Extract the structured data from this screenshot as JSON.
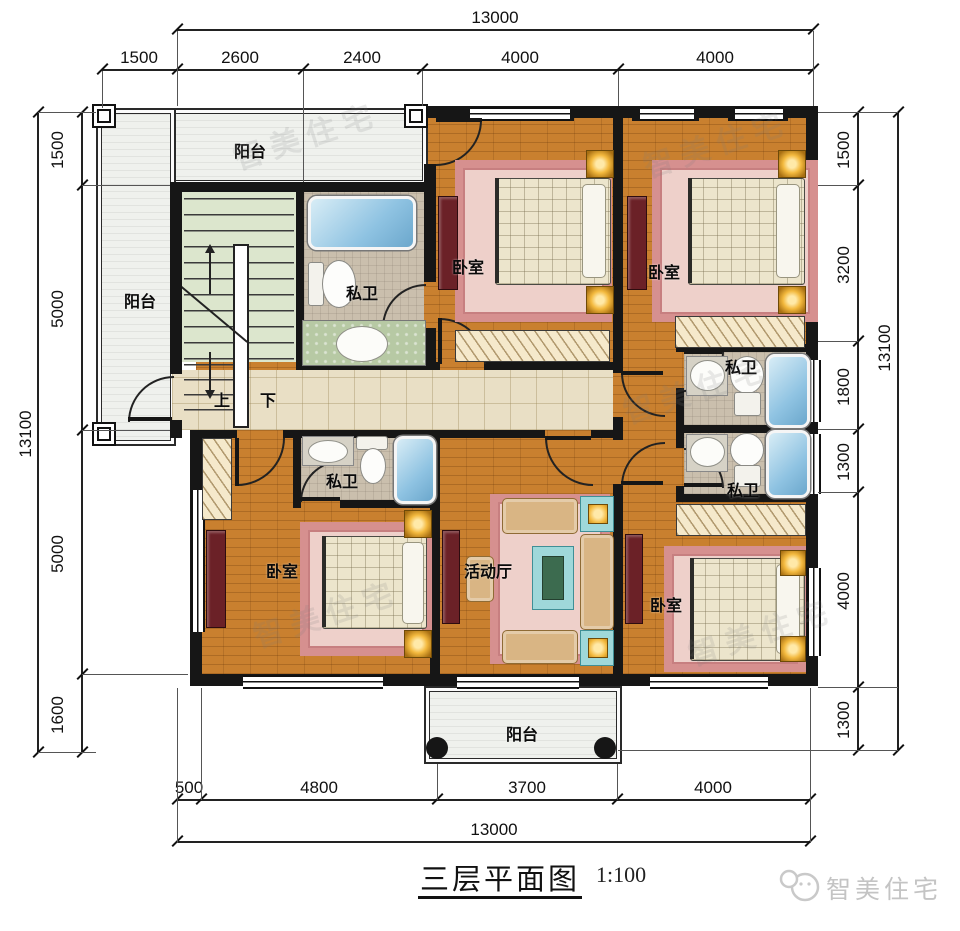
{
  "title": {
    "text": "三层平面图",
    "scale": "1:100"
  },
  "brand": {
    "name": "智美住宅"
  },
  "watermark": {
    "text": "智美住宅"
  },
  "dims": {
    "top": {
      "overall": "13000",
      "segments": [
        "1500",
        "2600",
        "2400",
        "4000",
        "4000"
      ]
    },
    "bottom": {
      "overall": "13000",
      "segments": [
        "500",
        "4800",
        "3700",
        "4000"
      ]
    },
    "left": {
      "overall": "13100",
      "segments": [
        "1500",
        "5000",
        "5000",
        "1600"
      ]
    },
    "right": {
      "overall": "13100",
      "segments": [
        "1500",
        "3200",
        "1800",
        "1300",
        "4000",
        "1300"
      ]
    }
  },
  "rooms": {
    "balcony_top": "阳台",
    "balcony_left": "阳台",
    "balcony_bottom": "阳台",
    "bath_top_left": "私卫",
    "bath_right_upper": "私卫",
    "bath_right_lower": "私卫",
    "bath_bottom_left": "私卫",
    "bedroom_top_middle": "卧室",
    "bedroom_top_right": "卧室",
    "bedroom_bottom_left": "卧室",
    "bedroom_bottom_right": "卧室",
    "hall": "活动厅",
    "stairs_up": "上",
    "stairs_down": "下"
  },
  "colors": {
    "wall": "#161616",
    "wood_floor": "#c9802f",
    "corridor": "#e9dfc5",
    "stairwell": "#dce6cd",
    "bathroom": "#cabfad",
    "balcony": "#eff1ed",
    "rug": "#d6908f",
    "sofa": "#d9b584",
    "accent_teal": "#9fd8da",
    "tv_cabinet": "#6b2127",
    "lamp": "#f3b93e",
    "bathtub": "#8fc3e2",
    "brand_gray": "#c4c4c4"
  }
}
